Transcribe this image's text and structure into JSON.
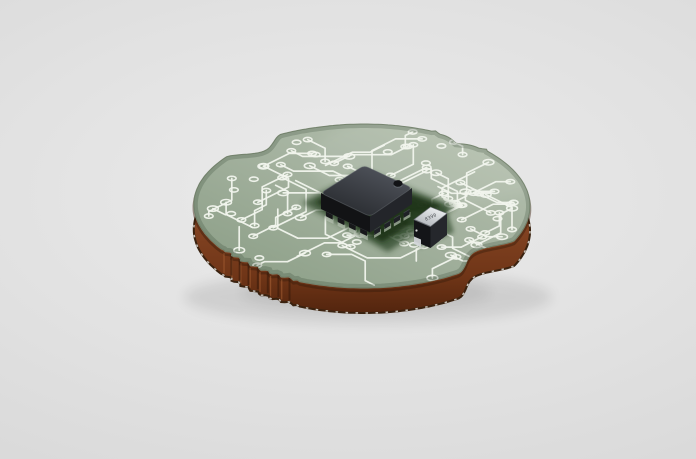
{
  "scene": {
    "type": "3d-product-render",
    "subject": "Round printed circuit board with a black IC chip and a small SMD component on a light gray studio background",
    "background": {
      "center_color": "#ebebeb",
      "mid_color": "#e1e1e1",
      "edge_color": "#d3d3d3"
    },
    "board": {
      "shape": "circular PCB with edge notches and castellated scallops",
      "top_color": "#a3b19e",
      "top_color_light": "#b8c3b2",
      "top_color_dark": "#8b9e86",
      "trace_color": "#f1f4ed",
      "edge_stroke_color": "#7e8c76",
      "side_color": "#8a4826",
      "side_color_light": "#9a5733",
      "side_color_dark": "#53250e",
      "bottom_rim_color": "#3a220f",
      "bottom_rim_dash_color": "#f4f4ef",
      "inner_shadow_color": "rgba(30,50,30,0.20)",
      "seam_color": "rgba(58,28,10,0.45)",
      "scallop_shadow_color": "rgba(48,21,8,0.5)",
      "scallop_highlight_color": "rgba(186,110,62,0.45)"
    },
    "chip": {
      "package": "QFN",
      "top_color_light": "#53575f",
      "top_color_mid": "#3a3d43",
      "top_color_dark": "#26292d",
      "edge_highlight": "#60646b",
      "front_left_color": "#121315",
      "front_right_color": "#23252a",
      "lead_color": "#17181a",
      "lead_color_right": "#1f2126",
      "lead_highlight": "#43464c",
      "solder_pad_color": "#b5c0b0",
      "dimple_color": "#121316",
      "dimple_highlight": "#6a7078",
      "landing_zone_color": "#2c4526",
      "landing_zone_dark": "#1e3319"
    },
    "component": {
      "type": "SMD device",
      "marking": "8390",
      "marking_color": "#4a4e52",
      "top_color_light": "#f0f2f4",
      "top_color_dark": "#aeb3b8",
      "top_edge_color": "#6b6f74",
      "body_color": "#141518",
      "side_color": "#25272c",
      "cap_color": "#d3d6d9"
    },
    "shadow_color": "#000000"
  }
}
